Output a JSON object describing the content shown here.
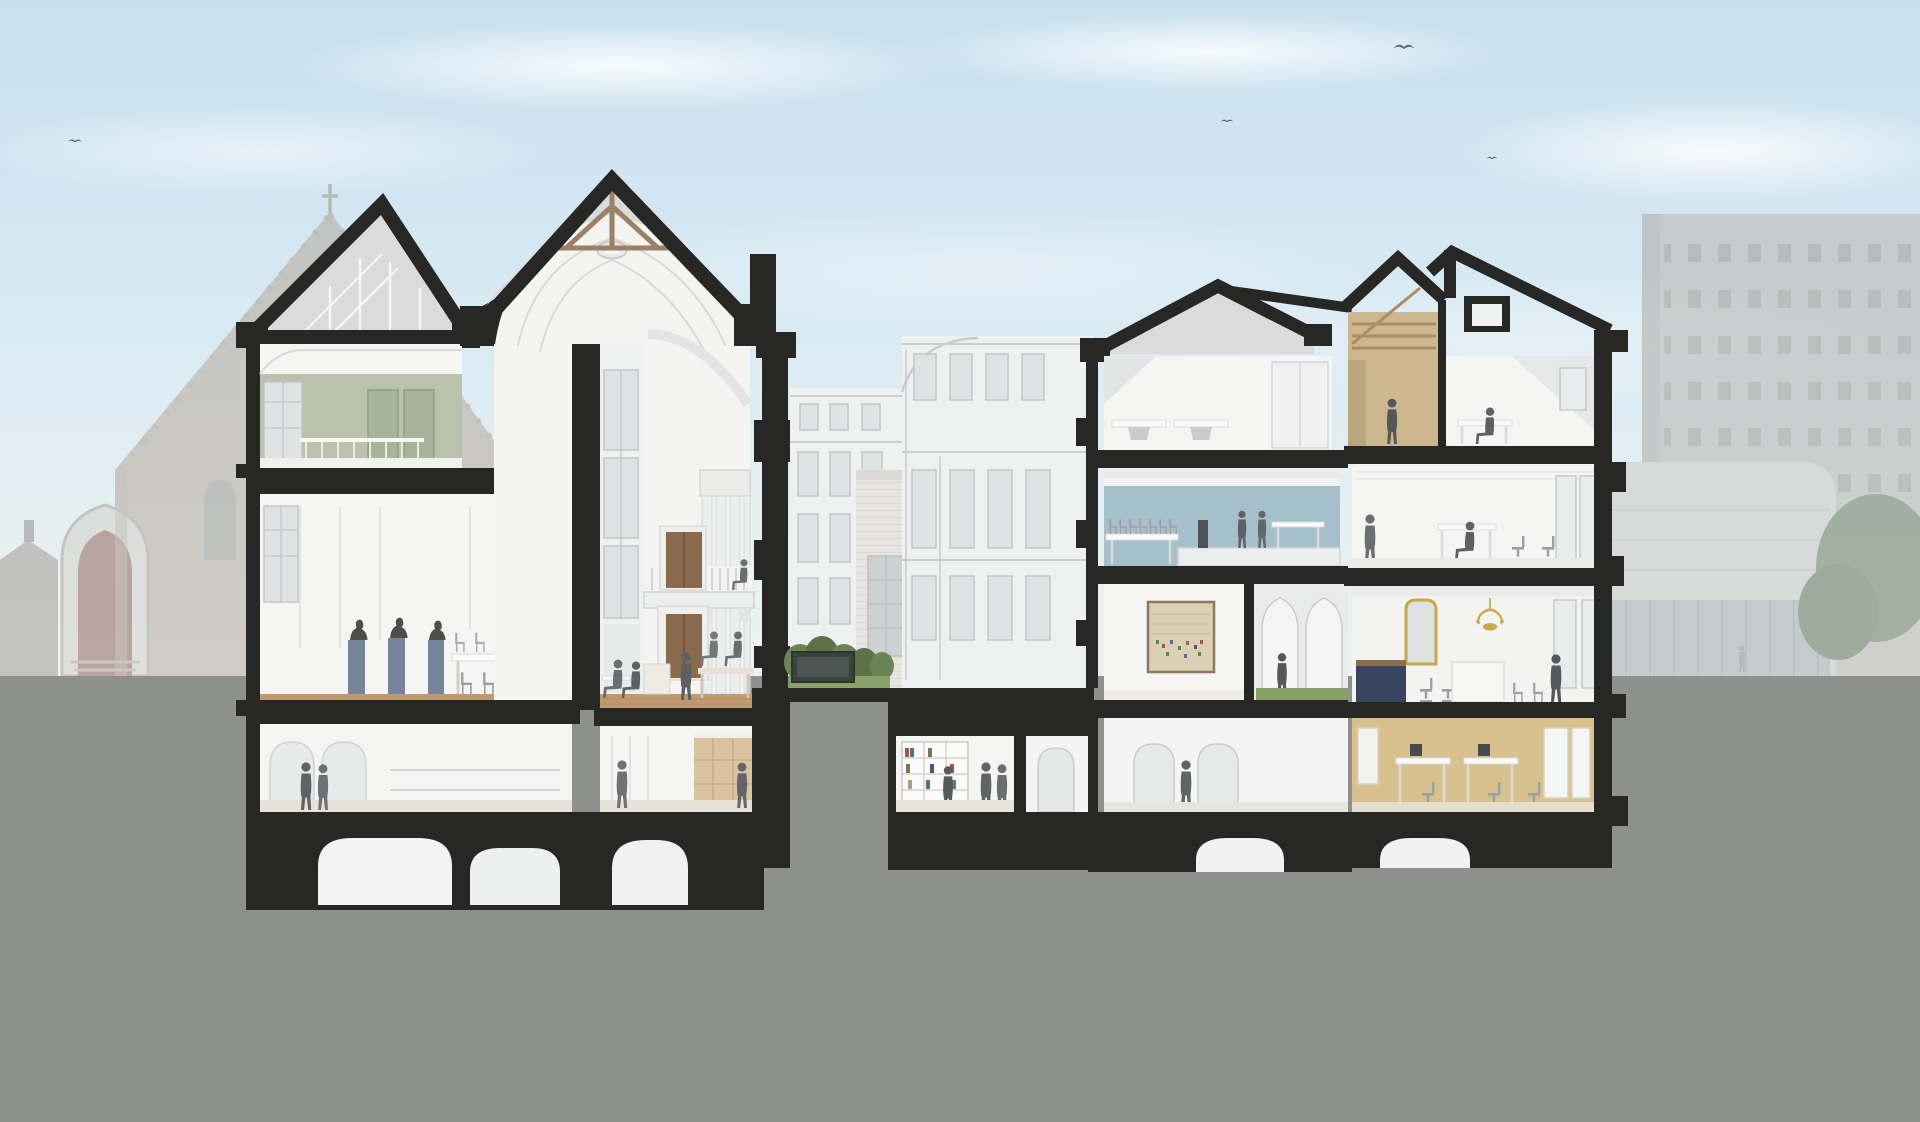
{
  "scene": {
    "title": "Sectional perspective rendering through the historic Binnenhof parliament buildings",
    "type": "architectural cross-section illustration",
    "description": "Cut-away section showing a tall vaulted assembly hall with timber roof trusses flanked by multi-storey wings, furnished interiors with silhouetted figures, vaulted cellars below grade, a courtyard garden, and faded photographic context buildings behind.",
    "background": {
      "left_building_label": "Gothic great hall (Ridderzaal) with rose window, gabled front and conical turret - faded",
      "right_building_label": "Modern parliament extension with curved drum and office slab - faded",
      "sky_label": "Pale blue sky with soft clouds",
      "birds_count": 4,
      "ground_label": "Neutral grey ground plane cut by basement vaults"
    },
    "rooms": [
      {
        "label": "Timber roof attic"
      },
      {
        "label": "Green salon"
      },
      {
        "label": "Committee room with portrait busts and long table"
      },
      {
        "label": "Entrance hall with arcade"
      },
      {
        "label": "Vaulted cellars"
      },
      {
        "label": "Great assembly hall with coved vault, oculus and balcony"
      },
      {
        "label": "Balcony gallery with panelled doors"
      },
      {
        "label": "Panelled lower lobby"
      },
      {
        "label": "Courtyard facades"
      },
      {
        "label": "Courtyard garden with planter"
      },
      {
        "label": "Attic washroom with basins"
      },
      {
        "label": "Blue committee room with mezzanine"
      },
      {
        "label": "Gallery with framed historic print"
      },
      {
        "label": "Arched corridor with green floor"
      },
      {
        "label": "Library room with bookcases"
      },
      {
        "label": "Arched ground-floor room"
      },
      {
        "label": "Timber-panelled attic room"
      },
      {
        "label": "Attic workplace"
      },
      {
        "label": "Open-plan office floor"
      },
      {
        "label": "Stately office with chandelier and gilt mirror"
      },
      {
        "label": "Ochre office room"
      },
      {
        "label": "Foundations"
      }
    ],
    "people_count": 25,
    "colors": {
      "sky_top": "#c7e0ef",
      "sky_mid": "#ddecf3",
      "sky_bottom": "#eef3f3",
      "ground": "#8e908e",
      "poche": "#272725",
      "room_white": "#f5f5f4",
      "timber": "#9a8167",
      "wood_floor": "#c09971",
      "sage_wall": "#b8c2ad",
      "steel_blue_wall": "#a5c0ca",
      "ochre_wall": "#d9c08f",
      "tan_panel": "#d9c49e",
      "attic_wood": "#ccb78f",
      "door_brown": "#8a6a4c",
      "gold": "#c9a84c",
      "garden_grass": "#8aa26c",
      "hedge_green": "#5e7147",
      "corridor_green": "#87a066",
      "people_grey": "#5d6164",
      "pedestal_blue": "#76849b",
      "print_paper": "#dbcfb6",
      "navy_cabinet": "#39455f",
      "bg_brick": "#ab9684",
      "bg_modern": "#b5b1ab"
    }
  }
}
